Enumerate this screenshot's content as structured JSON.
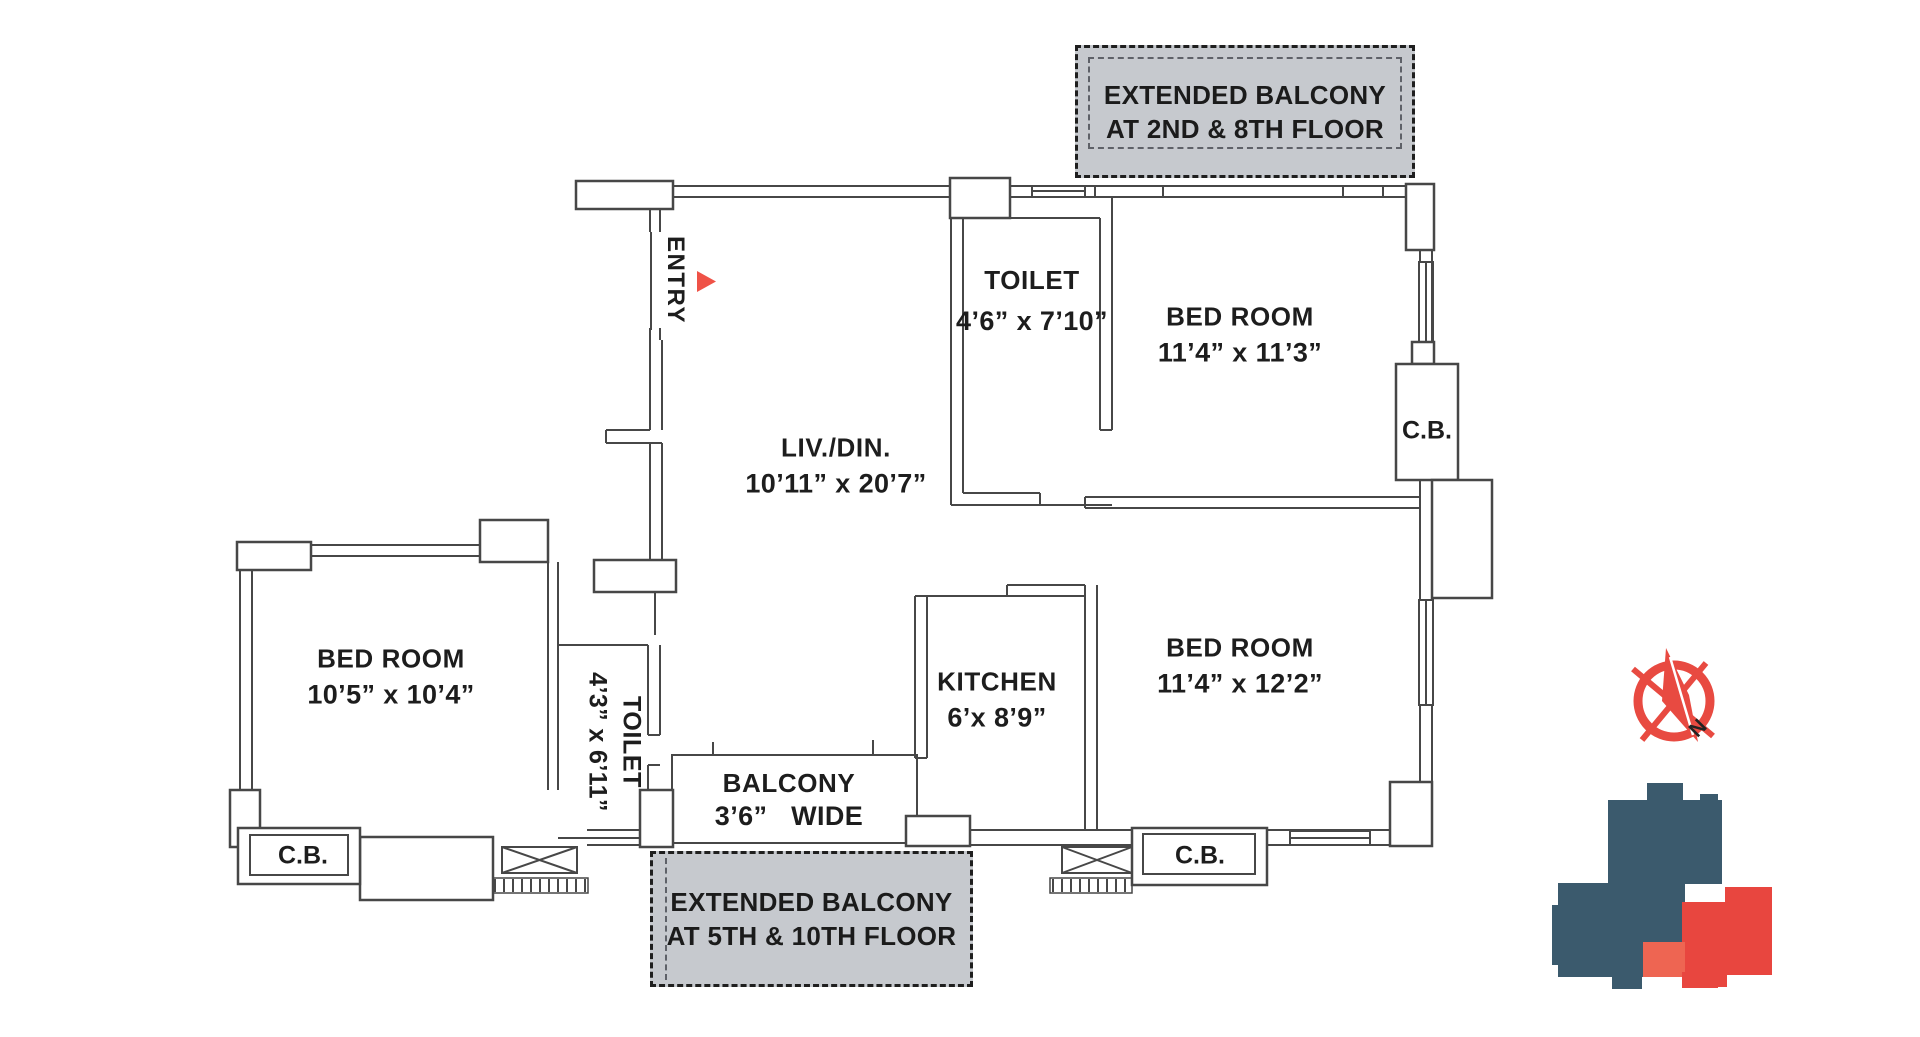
{
  "plan": {
    "entry_label": "ENTRY",
    "cb_label": "C.B.",
    "compass_north": "N",
    "rooms": {
      "living": {
        "name": "LIV./DIN.",
        "dims": "10’11” x 20’7”"
      },
      "toilet_top": {
        "name": "TOILET",
        "dims": "4’6” x 7’10”"
      },
      "bed_top_right": {
        "name": "BED ROOM",
        "dims": "11’4” x 11’3”"
      },
      "bed_bottom_right": {
        "name": "BED ROOM",
        "dims": "11’4” x 12’2”"
      },
      "bed_left": {
        "name": "BED ROOM",
        "dims": "10’5” x 10’4”"
      },
      "kitchen": {
        "name": "KITCHEN",
        "dims": "6’x 8’9”"
      },
      "toilet_bottom": {
        "name": "TOILET",
        "dims": "4’3” x 6’11”"
      },
      "balcony": {
        "name": "BALCONY",
        "dims": "3’6”   WIDE"
      }
    },
    "extended_balcony_top": {
      "line1": "EXTENDED BALCONY",
      "line2": "AT 2ND & 8TH FLOOR"
    },
    "extended_balcony_bottom": {
      "line1": "EXTENDED BALCONY",
      "line2": "AT 5TH & 10TH FLOOR"
    }
  },
  "colors": {
    "wall": "#474747",
    "balcony_fill": "#c6c9ce",
    "accent_red": "#e84a41",
    "logo_navy": "#3b5a6d",
    "logo_red": "#e8463f",
    "logo_red_light": "#ee6552"
  }
}
